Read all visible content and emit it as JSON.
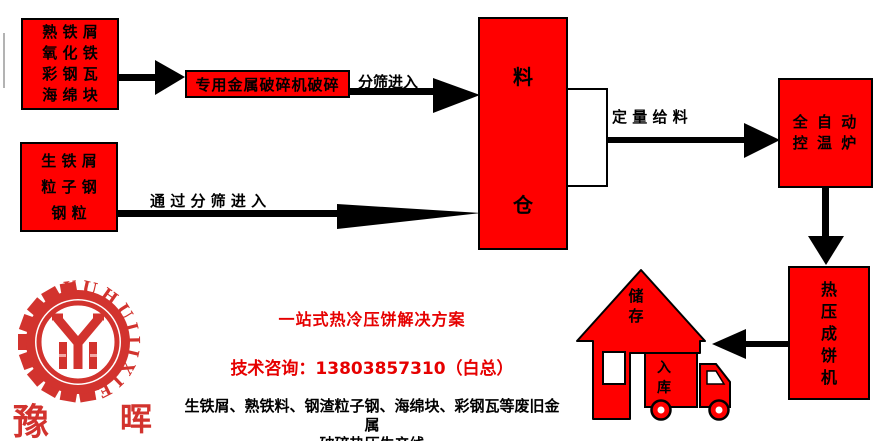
{
  "colors": {
    "box_red": "#ff0000",
    "accent_red": "#e60000",
    "logo_red": "#d2332e",
    "outline_black": "#000000"
  },
  "flow": {
    "source_box_top": {
      "lines": [
        "熟 铁 屑",
        "氧 化 铁",
        "彩 钢 瓦",
        "海 绵 块"
      ]
    },
    "crusher_box": {
      "label": "专用金属破碎机破碎"
    },
    "sieve_label": "分筛进入",
    "silo_box": {
      "chars": [
        "料",
        "仓"
      ]
    },
    "source_box_bottom": {
      "lines": [
        "生 铁 屑",
        "粒 子 钢",
        "钢 粒"
      ]
    },
    "through_sieve_label": "通 过 分 筛 进 入",
    "feed_label": "定 量 给 料",
    "furnace_box": {
      "lines": [
        "全 自 动",
        "控 温 炉"
      ]
    },
    "press_box": {
      "chars": [
        "热",
        "压",
        "成",
        "饼",
        "机"
      ]
    },
    "storage_house": {
      "chars": [
        "储",
        "存"
      ]
    },
    "warehouse_truck": {
      "chars": [
        "入",
        "库"
      ]
    }
  },
  "footer": {
    "slogan": "一站式热冷压饼解决方案",
    "contact": "技术咨询：13803857310（白总）",
    "description_line1": "生铁屑、熟铁料、钢渣粒子钢、海绵块、彩钢瓦等废旧金属",
    "description_line2": "破碎热压生产线"
  },
  "logo": {
    "arc_text": "YUHUIJIXIE",
    "char_left": "豫",
    "char_right": "晖"
  }
}
